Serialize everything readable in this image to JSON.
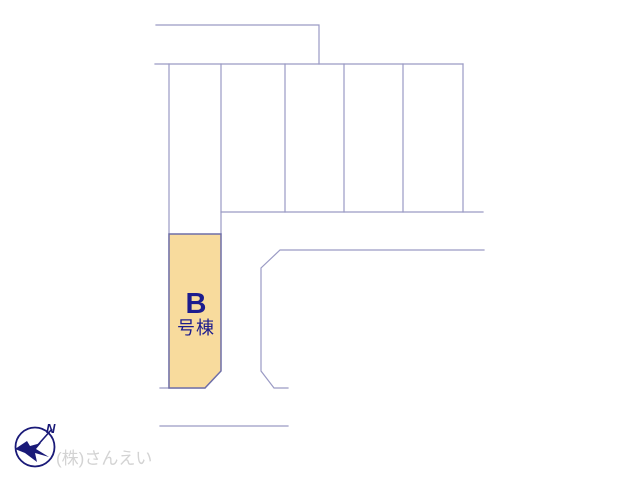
{
  "colors": {
    "background": "#ffffff",
    "boundary_line": "#9a9ac4",
    "plot_border": "#6e6ea8",
    "plot_fill": "#f8db9d",
    "plot_text": "#1c1c8e",
    "compass": "#1a1a78",
    "company_text": "#d3d3d3"
  },
  "plot_b": {
    "letter": "B",
    "suffix": "号棟"
  },
  "compass": {
    "north_label": "N"
  },
  "footer": {
    "company_name": "(株)さんえい"
  }
}
